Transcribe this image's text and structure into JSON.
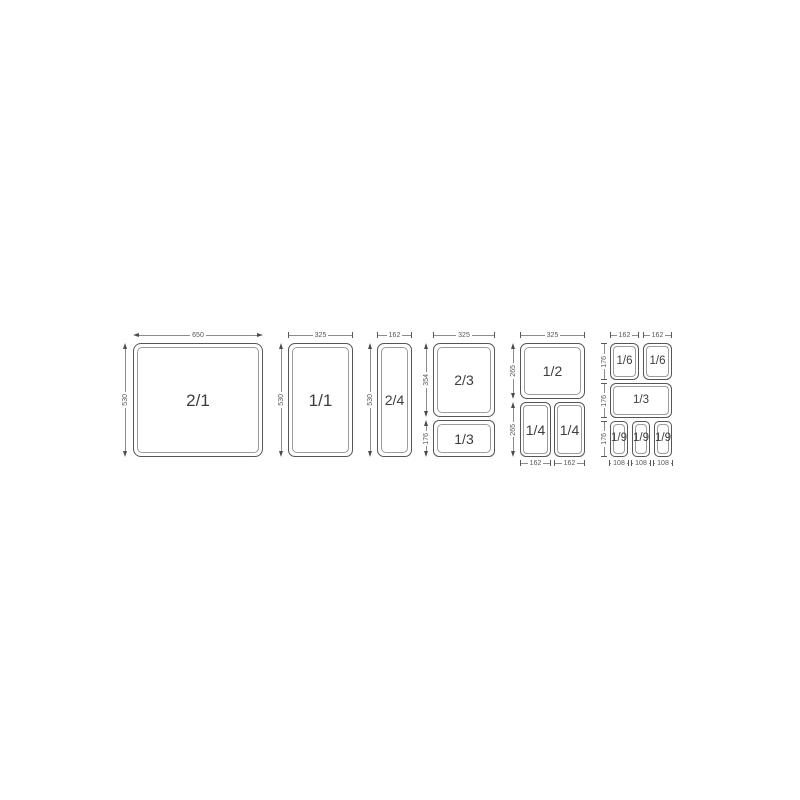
{
  "page": {
    "background": "#ffffff"
  },
  "diagram": {
    "type": "gastronorm-pan-size-chart",
    "line_color": "#565656",
    "inner_line_color": "#9b9b9b",
    "pan_text_color": "#3d3d3d",
    "dim_text_color": "#585858",
    "groups": [
      {
        "name": "gn-2-1",
        "pans": [
          {
            "label": "2/1"
          }
        ],
        "top_dims": [
          "650"
        ],
        "side_dims": [
          "530"
        ],
        "bottom_dims": []
      },
      {
        "name": "gn-1-1",
        "pans": [
          {
            "label": "1/1"
          }
        ],
        "top_dims": [
          "325"
        ],
        "side_dims": [
          "530"
        ],
        "bottom_dims": []
      },
      {
        "name": "gn-2-4",
        "pans": [
          {
            "label": "2/4"
          }
        ],
        "top_dims": [
          "162"
        ],
        "side_dims": [
          "530"
        ],
        "bottom_dims": []
      },
      {
        "name": "gn-2-3-and-1-3",
        "pans": [
          {
            "label": "2/3"
          },
          {
            "label": "1/3"
          }
        ],
        "top_dims": [
          "325"
        ],
        "side_dims": [
          "354",
          "176"
        ],
        "bottom_dims": []
      },
      {
        "name": "gn-1-2-and-1-4",
        "pans": [
          {
            "label": "1/2"
          },
          {
            "label": "1/4"
          },
          {
            "label": "1/4"
          }
        ],
        "top_dims": [
          "325"
        ],
        "side_dims": [
          "265",
          "265"
        ],
        "bottom_dims": [
          "162",
          "162"
        ]
      },
      {
        "name": "gn-1-6-1-3-1-9",
        "pans": [
          {
            "label": "1/6"
          },
          {
            "label": "1/6"
          },
          {
            "label": "1/3"
          },
          {
            "label": "1/9"
          },
          {
            "label": "1/9"
          },
          {
            "label": "1/9"
          }
        ],
        "top_dims": [
          "162",
          "162"
        ],
        "side_dims": [
          "176",
          "176",
          "176"
        ],
        "bottom_dims": [
          "108",
          "108",
          "108"
        ]
      }
    ]
  }
}
